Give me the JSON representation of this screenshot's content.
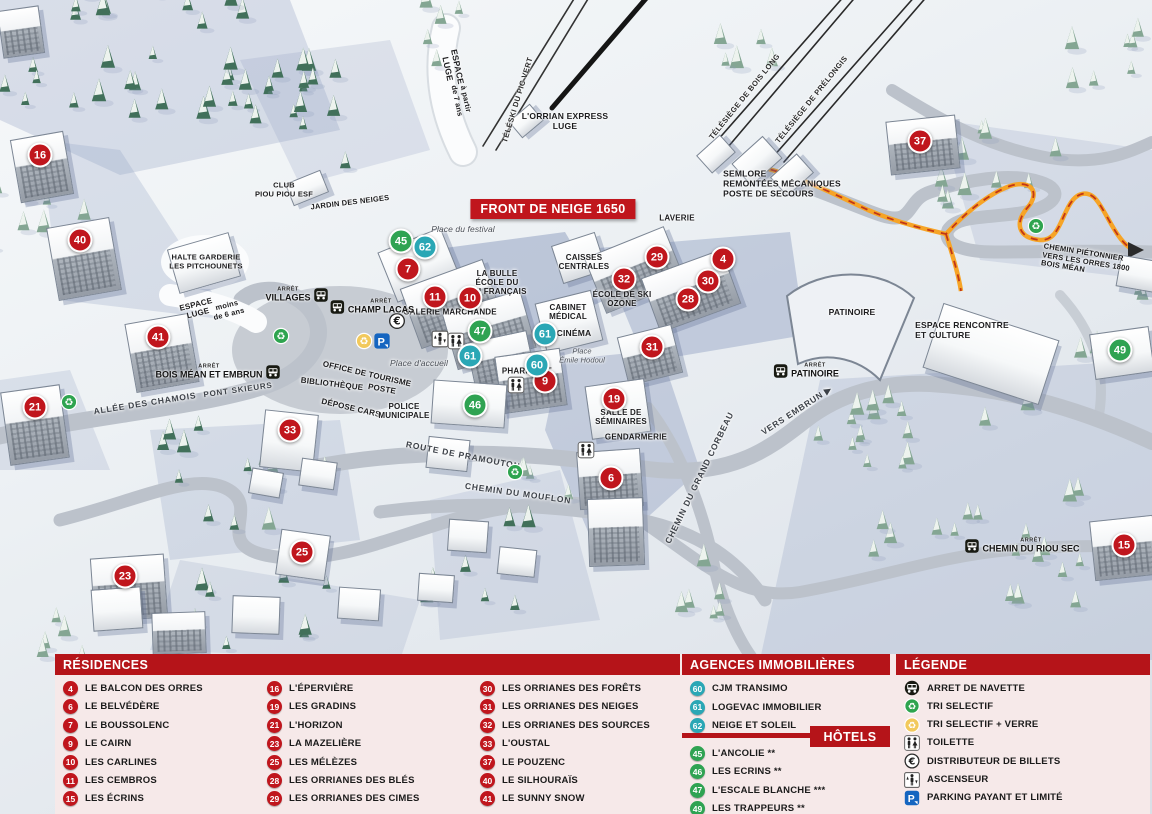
{
  "colors": {
    "red": "#c0161d",
    "teal": "#2aa7b5",
    "green": "#2fa352",
    "header": "#b51419",
    "panel_bg": "#f6e9e9"
  },
  "map": {
    "banner": "FRONT DE NEIGE 1650",
    "markers": [
      [
        "16",
        "r",
        40,
        155
      ],
      [
        "40",
        "r",
        80,
        240
      ],
      [
        "41",
        "r",
        158,
        337
      ],
      [
        "21",
        "r",
        35,
        407
      ],
      [
        "23",
        "r",
        125,
        576
      ],
      [
        "33",
        "r",
        290,
        430
      ],
      [
        "25",
        "r",
        302,
        552
      ],
      [
        "7",
        "r",
        408,
        269
      ],
      [
        "11",
        "r",
        435,
        297
      ],
      [
        "10",
        "r",
        470,
        298
      ],
      [
        "9",
        "r",
        545,
        381
      ],
      [
        "19",
        "r",
        614,
        399
      ],
      [
        "6",
        "r",
        611,
        478
      ],
      [
        "29",
        "r",
        657,
        257
      ],
      [
        "32",
        "r",
        624,
        279
      ],
      [
        "30",
        "r",
        708,
        281
      ],
      [
        "4",
        "r",
        723,
        259
      ],
      [
        "28",
        "r",
        688,
        299
      ],
      [
        "31",
        "r",
        652,
        347
      ],
      [
        "37",
        "r",
        920,
        141
      ],
      [
        "15",
        "r",
        1124,
        545
      ],
      [
        "45",
        "g",
        401,
        241
      ],
      [
        "47",
        "g",
        480,
        331
      ],
      [
        "46",
        "g",
        475,
        405
      ],
      [
        "49",
        "g",
        1120,
        350
      ],
      [
        "62",
        "t",
        425,
        247
      ],
      [
        "61",
        "t",
        470,
        356
      ],
      [
        "61",
        "t",
        545,
        334
      ],
      [
        "60",
        "t",
        537,
        365
      ]
    ],
    "labels": [
      {
        "t": "ESPACE\nLUGE",
        "x": 452,
        "y": 68,
        "r": 78,
        "s": 8.5
      },
      {
        "t": "à partir\nde 7 ans",
        "x": 461,
        "y": 100,
        "r": 78,
        "s": 7.5
      },
      {
        "t": "TÉLÉSKI DU PIC VERT",
        "x": 518,
        "y": 100,
        "r": -73,
        "s": 7.5,
        "c": "lift"
      },
      {
        "t": "L'ORRIAN EXPRESS\nLUGE",
        "x": 565,
        "y": 122,
        "s": 8.5
      },
      {
        "t": "TÉLÉSIÈGE DE BOIS LONG",
        "x": 745,
        "y": 97,
        "r": -51,
        "s": 7.5,
        "c": "lift"
      },
      {
        "t": "TÉLÉSIÈGE DE PRÉLONGIS",
        "x": 812,
        "y": 100,
        "r": -51,
        "s": 7.5,
        "c": "lift"
      },
      {
        "t": "SEMLORE\nREMONTÉES MÉCANIQUES\nPOSTE DE SECOURS",
        "x": 782,
        "y": 184,
        "s": 8.5,
        "c": "left"
      },
      {
        "t": "LAVERIE",
        "x": 677,
        "y": 218,
        "s": 8
      },
      {
        "t": "CAISSES\nCENTRALES",
        "x": 584,
        "y": 262,
        "s": 8
      },
      {
        "t": "LA BULLE\nÉCOLE DU\nSKI FRANÇAIS",
        "x": 497,
        "y": 283,
        "s": 8
      },
      {
        "t": "Place du festival",
        "x": 463,
        "y": 230,
        "s": 8.5,
        "c": "place"
      },
      {
        "t": "ÉCOLE DE SKI\nOZONE",
        "x": 622,
        "y": 299,
        "s": 8
      },
      {
        "t": "CABINET\nMÉDICAL",
        "x": 568,
        "y": 312,
        "s": 8
      },
      {
        "t": "CINÉMA",
        "x": 574,
        "y": 334,
        "s": 8.5
      },
      {
        "t": "Place\nÉmile Hodoul",
        "x": 582,
        "y": 356,
        "s": 7.5,
        "c": "place"
      },
      {
        "t": "GALERIE MARCHANDE",
        "x": 450,
        "y": 312,
        "s": 8
      },
      {
        "t": "PHARMACIE",
        "x": 527,
        "y": 371,
        "s": 8
      },
      {
        "t": "Place d'accueil",
        "x": 419,
        "y": 364,
        "s": 8.5,
        "c": "place"
      },
      {
        "t": "OFFICE DE TOURISME",
        "x": 367,
        "y": 374,
        "r": 13,
        "s": 8
      },
      {
        "t": "BIBLIOTHÈQUE",
        "x": 332,
        "y": 384,
        "r": 7,
        "s": 8
      },
      {
        "t": "POSTE",
        "x": 382,
        "y": 389,
        "r": 10,
        "s": 8
      },
      {
        "t": "DÉPOSE CARS",
        "x": 351,
        "y": 408,
        "r": 13,
        "s": 8
      },
      {
        "t": "POLICE\nMUNICIPALE",
        "x": 404,
        "y": 411,
        "s": 8
      },
      {
        "t": "SALLE DE\nSÉMINAIRES",
        "x": 621,
        "y": 417,
        "s": 8
      },
      {
        "t": "GENDARMERIE",
        "x": 636,
        "y": 437,
        "s": 8
      },
      {
        "t": "ROUTE DE PRAMOUTON",
        "x": 463,
        "y": 456,
        "r": 11,
        "s": 8.5,
        "c": "road"
      },
      {
        "t": "CHEMIN DU MOUFLON",
        "x": 518,
        "y": 494,
        "r": 8,
        "s": 8.5,
        "c": "road"
      },
      {
        "t": "CHEMIN DU GRAND CORBEAU",
        "x": 700,
        "y": 478,
        "r": -64,
        "s": 8.5,
        "c": "road"
      },
      {
        "t": "VERS EMBRUN ▶",
        "x": 797,
        "y": 411,
        "r": -33,
        "s": 8.5,
        "c": "road"
      },
      {
        "t": "ALLÉE DES CHAMOIS",
        "x": 145,
        "y": 404,
        "r": -9,
        "s": 8.5,
        "c": "road"
      },
      {
        "t": "PONT SKIEURS",
        "x": 238,
        "y": 390,
        "r": -8,
        "s": 8,
        "c": "road"
      },
      {
        "t": "HALTE GARDERIE\nLES PITCHOUNETS",
        "x": 206,
        "y": 262,
        "s": 7.5
      },
      {
        "t": "ESPACE\nLUGE",
        "x": 197,
        "y": 309,
        "r": -14,
        "s": 8
      },
      {
        "t": "moins\nde 6 ans",
        "x": 228,
        "y": 310,
        "r": -14,
        "s": 7.5
      },
      {
        "t": "CLUB\nPIOU PIOU ESF",
        "x": 284,
        "y": 190,
        "s": 7.5
      },
      {
        "t": "JARDIN DES NEIGES",
        "x": 350,
        "y": 203,
        "r": -7,
        "s": 7.5
      },
      {
        "t": "ESPACE RENCONTRE\nET CULTURE",
        "x": 962,
        "y": 331,
        "s": 8.5,
        "c": "left"
      },
      {
        "t": "PATINOIRE",
        "x": 852,
        "y": 313,
        "s": 8.5
      },
      {
        "t": "CHEMIN PIÉTONNIER\nVERS LES ORRES 1800\nBOIS MÉAN",
        "x": 1086,
        "y": 262,
        "r": 9,
        "s": 7.5,
        "c": "left"
      }
    ],
    "stops": [
      {
        "t": "VILLAGES",
        "x": 297,
        "y": 295,
        "side": "right"
      },
      {
        "t": "CHAMP LACAS",
        "x": 372,
        "y": 307,
        "side": "left"
      },
      {
        "t": "BOIS MÉAN ET EMBRUN",
        "x": 218,
        "y": 372,
        "side": "right"
      },
      {
        "t": "PATINOIRE",
        "x": 806,
        "y": 371,
        "side": "left"
      },
      {
        "t": "CHEMIN DU RIOU SEC",
        "x": 1022,
        "y": 546,
        "side": "left"
      }
    ],
    "icons": [
      {
        "k": "recycle-green",
        "x": 281,
        "y": 336
      },
      {
        "k": "recycle-green",
        "x": 69,
        "y": 402
      },
      {
        "k": "recycle-green",
        "x": 515,
        "y": 472
      },
      {
        "k": "recycle-green",
        "x": 1036,
        "y": 226
      },
      {
        "k": "recycle-yellow",
        "x": 364,
        "y": 341
      },
      {
        "k": "euro",
        "x": 397,
        "y": 321
      },
      {
        "k": "parking",
        "x": 382,
        "y": 341
      },
      {
        "k": "elevator",
        "x": 440,
        "y": 339
      },
      {
        "k": "toilet",
        "x": 456,
        "y": 341
      },
      {
        "k": "toilet",
        "x": 516,
        "y": 385
      },
      {
        "k": "toilet",
        "x": 586,
        "y": 450
      }
    ]
  },
  "panel": {
    "residences": {
      "title": "RÉSIDENCES",
      "items": [
        [
          "4",
          "LE BALCON DES ORRES"
        ],
        [
          "6",
          "LE BELVÉDÈRE"
        ],
        [
          "7",
          "LE BOUSSOLENC"
        ],
        [
          "9",
          "LE CAIRN"
        ],
        [
          "10",
          "LES CARLINES"
        ],
        [
          "11",
          "LES CEMBROS"
        ],
        [
          "15",
          "LES ÉCRINS"
        ],
        [
          "16",
          "L'ÉPERVIÈRE"
        ],
        [
          "19",
          "LES GRADINS"
        ],
        [
          "21",
          "L'HORIZON"
        ],
        [
          "23",
          "LA MAZELIÈRE"
        ],
        [
          "25",
          "LES MÉLÈZES"
        ],
        [
          "28",
          "LES ORRIANES DES BLÉS"
        ],
        [
          "29",
          "LES ORRIANES DES CIMES"
        ],
        [
          "30",
          "LES ORRIANES DES FORÊTS"
        ],
        [
          "31",
          "LES ORRIANES DES NEIGES"
        ],
        [
          "32",
          "LES ORRIANES DES SOURCES"
        ],
        [
          "33",
          "L'OUSTAL"
        ],
        [
          "37",
          "LE POUZENC"
        ],
        [
          "40",
          "LE SILHOURAÏS"
        ],
        [
          "41",
          "LE SUNNY SNOW"
        ]
      ]
    },
    "agences": {
      "title": "AGENCES IMMOBILIÈRES",
      "items": [
        [
          "60",
          "CJM TRANSIMO"
        ],
        [
          "61",
          "LOGEVAC IMMOBILIER"
        ],
        [
          "62",
          "NEIGE ET SOLEIL"
        ]
      ]
    },
    "hotels": {
      "title": "HÔTELS",
      "items": [
        [
          "45",
          "L'ANCOLIE **"
        ],
        [
          "46",
          "LES ECRINS **"
        ],
        [
          "47",
          "L'ESCALE BLANCHE ***"
        ],
        [
          "49",
          "LES TRAPPEURS **"
        ]
      ]
    },
    "legende": {
      "title": "LÉGENDE",
      "items": [
        [
          "bus",
          "ARRET DE NAVETTE"
        ],
        [
          "recycle-green",
          "TRI SELECTIF"
        ],
        [
          "recycle-yellow",
          "TRI SELECTIF + VERRE"
        ],
        [
          "toilet",
          "TOILETTE"
        ],
        [
          "euro",
          "DISTRIBUTEUR DE BILLETS"
        ],
        [
          "elevator",
          "ASCENSEUR"
        ],
        [
          "parking",
          "PARKING PAYANT ET LIMITÉ"
        ]
      ]
    }
  }
}
